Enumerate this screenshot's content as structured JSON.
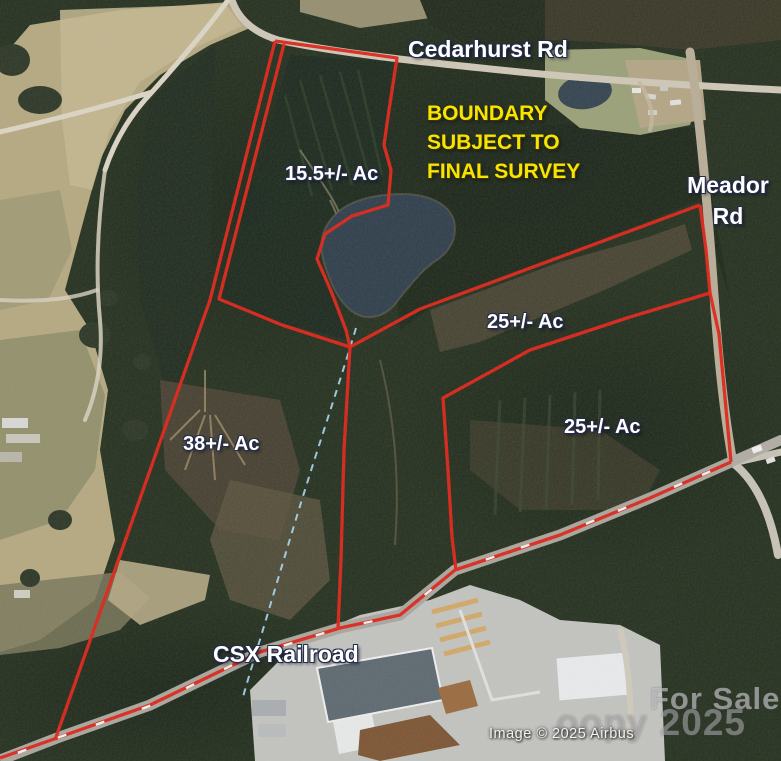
{
  "map": {
    "type": "annotated satellite real-estate boundary map",
    "roads": {
      "top_road": "Cedarhurst Rd",
      "right_road_line1": "Meador",
      "right_road_line2": "Rd",
      "railroad": "CSX Railroad"
    },
    "disclaimer": {
      "line1": "BOUNDARY",
      "line2": "SUBJECT TO",
      "line3": "FINAL SURVEY"
    },
    "parcels": [
      {
        "label": "15.5+/- Ac"
      },
      {
        "label": "25+/- Ac"
      },
      {
        "label": "25+/- Ac"
      },
      {
        "label": "38+/- Ac"
      }
    ],
    "watermark": {
      "line1": "For Sale",
      "line2": "oopy 2025"
    },
    "attribution": "Image © 2025 Airbus",
    "colors": {
      "boundary_red": "#df2318",
      "disclaimer_yellow": "#f8e400",
      "label_white": "#ffffff",
      "creek_blue": "#a8d9f6",
      "pond_water": "#2e3e4b",
      "field_tan": "#b5a981",
      "forest_dark": "#1e2a1e"
    }
  }
}
